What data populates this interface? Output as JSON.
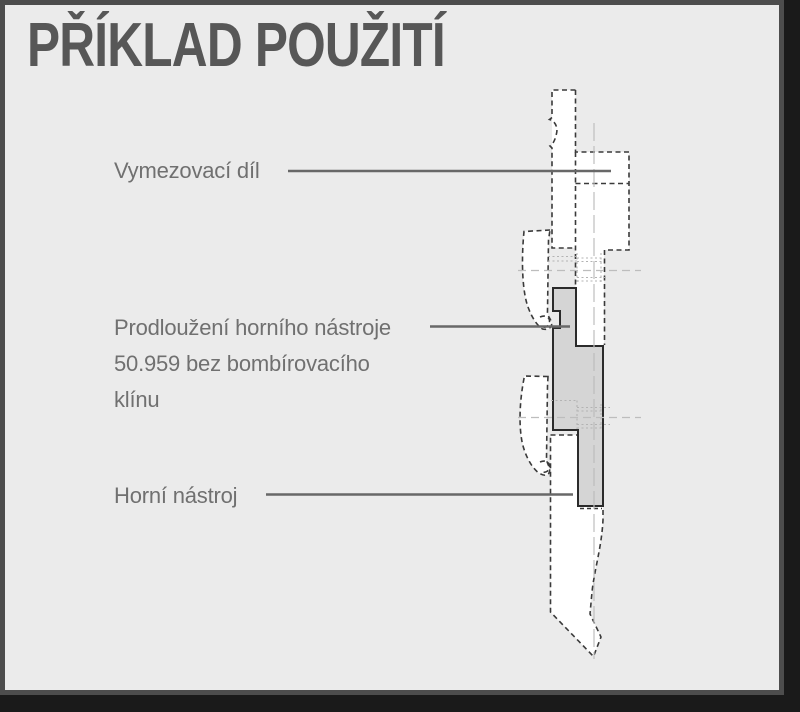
{
  "page": {
    "title": "PŘÍKLAD POUŽITÍ"
  },
  "labels": {
    "spacer": {
      "text": "Vymezovací díl"
    },
    "extension": {
      "lines": [
        "Prodloužení horního nástroje",
        "50.959 bez bombírovacího",
        "klínu"
      ]
    },
    "upper_tool": {
      "text": "Horní nástroj"
    }
  },
  "colors": {
    "outer_bg": "#1a1a1a",
    "frame": "#4d4d4d",
    "card_bg": "#ebebeb",
    "title_text": "#575757",
    "label_text": "#707070",
    "leader_line": "#686868",
    "part_fill": "#d5d5d5",
    "part_outline": "#2b2b2b",
    "dashed_outline": "#3a3a3a",
    "hidden_line": "#b3b3b3",
    "construction_line": "#bdbdbd"
  }
}
